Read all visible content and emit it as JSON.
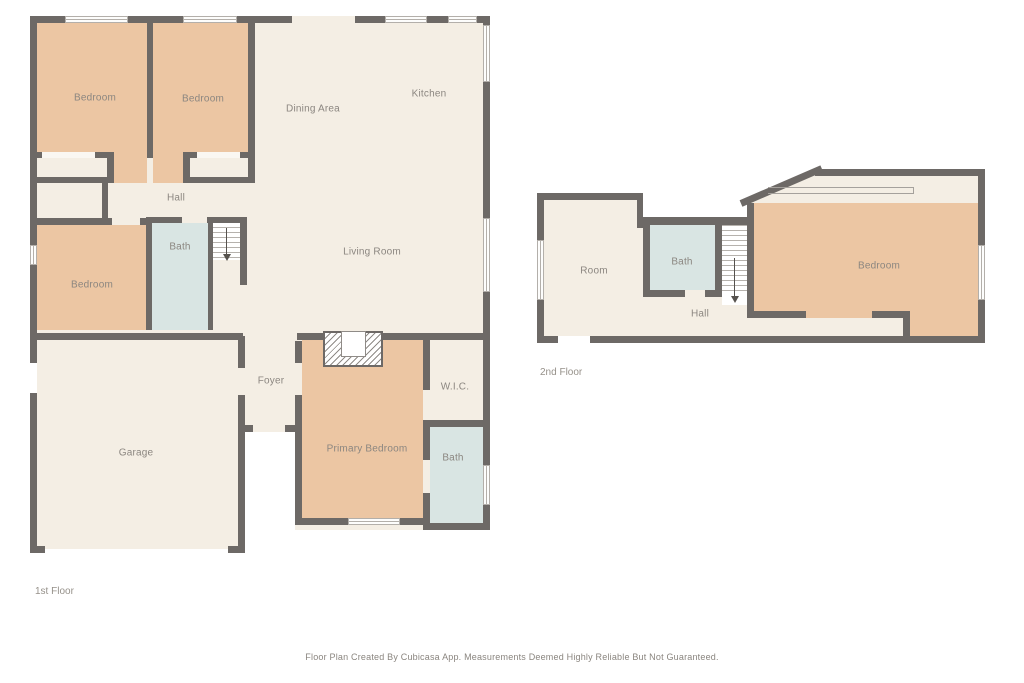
{
  "palette": {
    "wall": "#6d6966",
    "room": "#f4eee4",
    "bedroom": "#ecc6a3",
    "bath": "#d9e5e3",
    "label": "#8b8680"
  },
  "floor1": {
    "title": "1st Floor",
    "labels": {
      "bedroom_tl": "Bedroom",
      "bedroom_tm": "Bedroom",
      "dining": "Dining Area",
      "kitchen": "Kitchen",
      "hall": "Hall",
      "bath": "Bath",
      "bedroom_ml": "Bedroom",
      "living": "Living Room",
      "foyer": "Foyer",
      "garage": "Garage",
      "primary": "Primary Bedroom",
      "wic": "W.I.C.",
      "bath2": "Bath"
    }
  },
  "floor2": {
    "title": "2nd Floor",
    "labels": {
      "room": "Room",
      "bath": "Bath",
      "hall": "Hall",
      "bedroom": "Bedroom"
    }
  },
  "footer": "Floor Plan Created By Cubicasa App. Measurements Deemed Highly Reliable But Not Guaranteed."
}
